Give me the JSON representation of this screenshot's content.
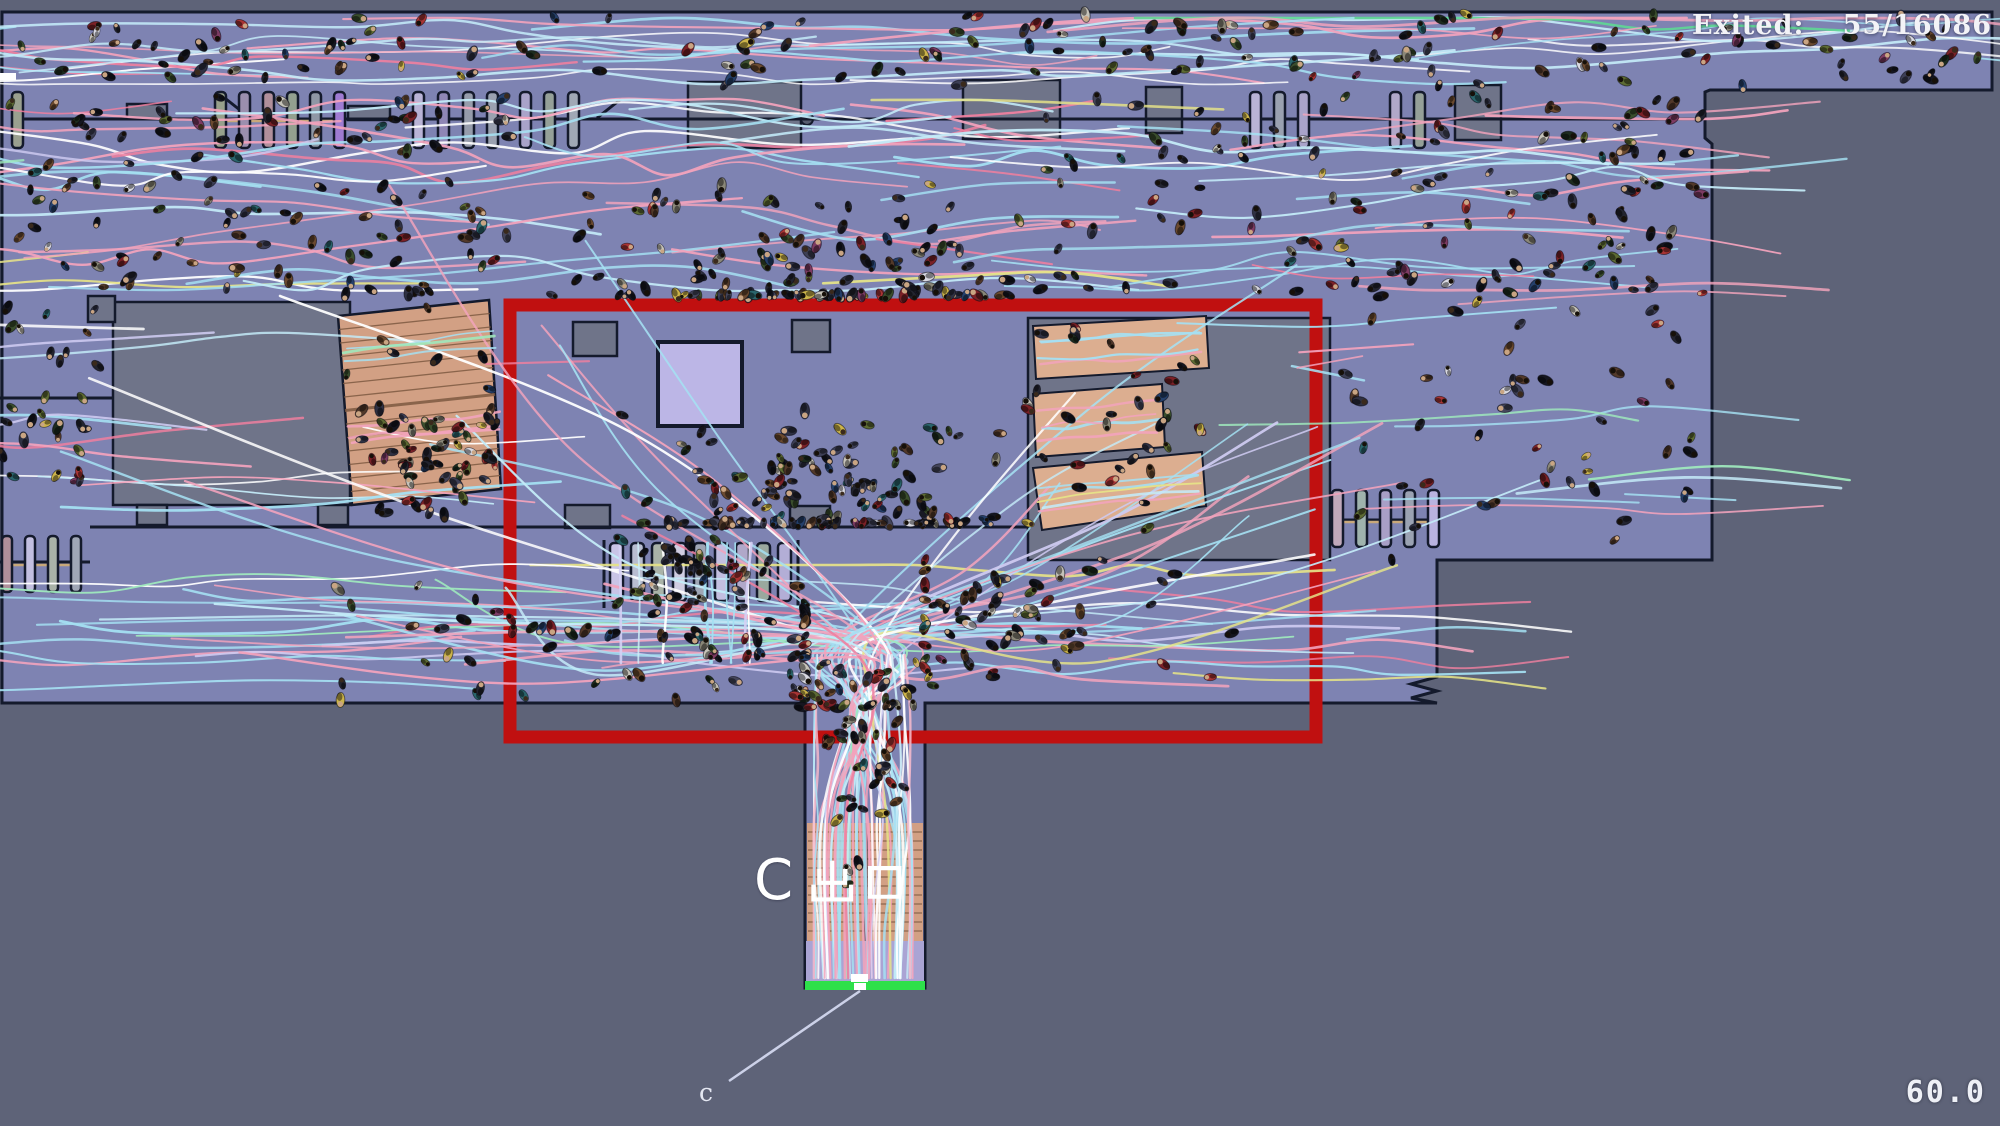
{
  "hud": {
    "exited_label": "Exited:",
    "exited_value": "55/16086",
    "timer": "60.0"
  },
  "labels": {
    "exit_sign": "C 出口",
    "exit_letter": "C",
    "leader": "c"
  },
  "colors": {
    "outside": "#5e6378",
    "floor": "#7e83b2",
    "block": "#6f7489",
    "wall": "#141a2c",
    "stair_tan": "#d2a084",
    "stair_step": "#7e5a42",
    "ramp_tan": "#dcae90",
    "lavender_block": "#bcb6e6",
    "corridor_lavender": "#aaa4d4",
    "exit_green": "#2ee04a",
    "highlight_red": "#c01010",
    "leader_line": "#ccd1e8",
    "accent_tan": "#c8a87a",
    "white": "#ffffff"
  },
  "scene": {
    "width": 2000,
    "height": 1126,
    "seed": 11,
    "floor_points": [
      [
        8,
        12
      ],
      [
        1992,
        12
      ],
      [
        1992,
        90
      ],
      [
        1710,
        90
      ],
      [
        1705,
        92
      ],
      [
        1705,
        138
      ],
      [
        1712,
        144
      ],
      [
        1712,
        560
      ],
      [
        1437,
        560
      ],
      [
        1437,
        677
      ],
      [
        1411,
        684
      ],
      [
        1437,
        691
      ],
      [
        1411,
        698
      ],
      [
        1437,
        703
      ],
      [
        925,
        703
      ],
      [
        925,
        988
      ],
      [
        805,
        988
      ],
      [
        805,
        703
      ],
      [
        2,
        703
      ],
      [
        2,
        12
      ]
    ],
    "walls": [
      [
        12,
        119,
        1698,
        119
      ],
      [
        250,
        118,
        226,
        99
      ],
      [
        597,
        118,
        621,
        99
      ],
      [
        0,
        398,
        113,
        398
      ],
      [
        90,
        527,
        1028,
        527
      ],
      [
        0,
        562,
        90,
        562
      ],
      [
        1330,
        520,
        1437,
        520
      ],
      [
        604,
        540,
        604,
        608
      ],
      [
        798,
        540,
        798,
        608
      ]
    ],
    "accents": [
      [
        215,
        121,
        345,
        121
      ],
      [
        10,
        565,
        72,
        565
      ],
      [
        1333,
        522,
        1434,
        522
      ]
    ],
    "blocks": [
      [
        113,
        302,
        237,
        203
      ],
      [
        88,
        296,
        27,
        26
      ],
      [
        137,
        505,
        30,
        20
      ],
      [
        318,
        505,
        30,
        20
      ],
      [
        573,
        322,
        44,
        34
      ],
      [
        792,
        320,
        38,
        32
      ],
      [
        565,
        505,
        45,
        23
      ],
      [
        790,
        506,
        40,
        21
      ],
      [
        1028,
        318,
        302,
        242
      ],
      [
        127,
        104,
        40,
        15
      ],
      [
        348,
        106,
        42,
        14
      ],
      [
        688,
        82,
        113,
        66
      ],
      [
        963,
        80,
        97,
        59
      ],
      [
        1146,
        87,
        36,
        46
      ],
      [
        1455,
        85,
        46,
        55
      ]
    ],
    "kiosk_circle": [
      807,
      119,
      6
    ],
    "white_tick": [
      0,
      73,
      16,
      7
    ],
    "left_stair": {
      "quad": [
        [
          338,
          316
        ],
        [
          489,
          300
        ],
        [
          501,
          489
        ],
        [
          352,
          505
        ]
      ],
      "steps": 14
    },
    "ramps": [
      {
        "quad": [
          [
            1033,
            326
          ],
          [
            1206,
            316
          ],
          [
            1209,
            368
          ],
          [
            1036,
            379
          ]
        ]
      },
      {
        "quad": [
          [
            1033,
            394
          ],
          [
            1162,
            384
          ],
          [
            1165,
            447
          ],
          [
            1036,
            457
          ]
        ]
      },
      {
        "quad": [
          [
            1033,
            468
          ],
          [
            1202,
            452
          ],
          [
            1206,
            506
          ],
          [
            1042,
            530
          ]
        ]
      }
    ],
    "corridor": {
      "stair_left": [
        807,
        823,
        57,
        118
      ],
      "stair_right": [
        866,
        823,
        57,
        118
      ],
      "divider": [
        866,
        823,
        866,
        941
      ],
      "steps_y": [
        832,
        932,
        9
      ],
      "lavender": [
        806,
        941,
        118,
        41
      ],
      "green": [
        805,
        981,
        120,
        9
      ],
      "ticks": [
        [
          851,
          974,
          17,
          8
        ],
        [
          854,
          983,
          12,
          7
        ]
      ]
    },
    "gate_rows": [
      {
        "y": 92,
        "h": 56,
        "w": 11,
        "bars": [
          [
            12,
            "#9aa08f"
          ],
          [
            215,
            "#97a08b"
          ],
          [
            239,
            "#9b8fae"
          ],
          [
            263,
            "#b08f9b"
          ],
          [
            287,
            "#93a08f"
          ],
          [
            310,
            "#8f97a5"
          ],
          [
            334,
            "#9f7bd2"
          ],
          [
            413,
            "#b9b3d6"
          ],
          [
            438,
            "#8f86b5"
          ],
          [
            463,
            "#969cab"
          ],
          [
            487,
            "#9aa1b0"
          ],
          [
            520,
            "#a9a3c9"
          ],
          [
            544,
            "#95a098"
          ],
          [
            568,
            "#a0a8b5"
          ],
          [
            1250,
            "#b9b3d6"
          ],
          [
            1274,
            "#9aa1b0"
          ],
          [
            1298,
            "#a9a3c9"
          ],
          [
            1390,
            "#b0a8c9"
          ],
          [
            1414,
            "#95a098"
          ]
        ]
      },
      {
        "y": 543,
        "h": 58,
        "w": 13,
        "bars": [
          [
            610,
            "#c9c4e6"
          ],
          [
            631,
            "#b8bdd0"
          ],
          [
            652,
            "#aab3a8"
          ],
          [
            673,
            "#d0cde2"
          ],
          [
            694,
            "#9fa6b5"
          ],
          [
            715,
            "#c3bfe0"
          ],
          [
            736,
            "#b0a8c9"
          ],
          [
            757,
            "#9aa89e"
          ],
          [
            778,
            "#b3aed6"
          ]
        ]
      },
      {
        "y": 536,
        "h": 56,
        "w": 10,
        "bars": [
          [
            2,
            "#b08f9b"
          ],
          [
            25,
            "#c3bfe0"
          ],
          [
            48,
            "#aab3a8"
          ],
          [
            71,
            "#9fa6b5"
          ]
        ]
      },
      {
        "y": 490,
        "h": 57,
        "w": 11,
        "bars": [
          [
            1332,
            "#c0a9bb"
          ],
          [
            1356,
            "#9fb3ad"
          ],
          [
            1380,
            "#a89fc6"
          ],
          [
            1404,
            "#9aa2b2"
          ],
          [
            1428,
            "#b9b3e0"
          ]
        ]
      }
    ],
    "red_box": [
      510,
      305,
      806,
      432
    ],
    "red_box_stroke": 13,
    "leader_line": [
      860,
      991,
      729,
      1081
    ],
    "trail_palette": [
      [
        "#a5e0f2",
        30
      ],
      [
        "#c4ebf8",
        12
      ],
      [
        "#f2a3bc",
        22
      ],
      [
        "#ee7f9f",
        7
      ],
      [
        "#ffffff",
        12
      ],
      [
        "#cecaf0",
        7
      ],
      [
        "#9fe9bd",
        5
      ],
      [
        "#5fd794",
        2
      ],
      [
        "#e6e388",
        3
      ]
    ],
    "trail_palette_light": [
      [
        "#ffffff",
        35
      ],
      [
        "#cfeef8",
        25
      ],
      [
        "#a5e0f2",
        20
      ],
      [
        "#d4d0f4",
        12
      ],
      [
        "#f4b9cb",
        8
      ]
    ],
    "trail_groups": [
      {
        "type": "h",
        "region": [
          10,
          18,
          1975,
          66
        ],
        "count": 30,
        "amp": 28,
        "len": [
          500,
          1500
        ]
      },
      {
        "type": "h",
        "region": [
          5,
          100,
          1000,
          190
        ],
        "count": 38,
        "amp": 44,
        "len": [
          380,
          1050
        ]
      },
      {
        "type": "h",
        "region": [
          1000,
          100,
          700,
          190
        ],
        "count": 24,
        "amp": 38,
        "len": [
          320,
          850
        ]
      },
      {
        "type": "h",
        "region": [
          1340,
          115,
          355,
          420
        ],
        "count": 15,
        "amp": 30,
        "len": [
          220,
          480
        ]
      },
      {
        "type": "h",
        "region": [
          5,
          565,
          1420,
          125
        ],
        "count": 26,
        "amp": 30,
        "len": [
          380,
          1150
        ]
      },
      {
        "type": "h",
        "region": [
          5,
          315,
          495,
          195
        ],
        "count": 13,
        "amp": 34,
        "len": [
          240,
          600
        ]
      },
      {
        "type": "funnel",
        "sources": [
          [
            5,
            110,
            620,
            420
          ],
          [
            950,
            110,
            680,
            380
          ],
          [
            1230,
            420,
            200,
            230
          ],
          [
            30,
            565,
            580,
            120
          ]
        ],
        "target": [
          863,
          700
        ],
        "count": 46
      },
      {
        "type": "v",
        "region": [
          814,
          655,
          96,
          323
        ],
        "count": 12,
        "palette": "light"
      },
      {
        "type": "v",
        "region": [
          612,
          543,
          180,
          120
        ],
        "count": 9,
        "palette": "light"
      },
      {
        "type": "along",
        "line": [
          1040,
          350,
          1200,
          340
        ],
        "count": 4,
        "spread": 16
      },
      {
        "type": "along",
        "line": [
          1040,
          424,
          1158,
          414
        ],
        "count": 4,
        "spread": 17
      },
      {
        "type": "along",
        "line": [
          1040,
          497,
          1198,
          480
        ],
        "count": 5,
        "spread": 17
      },
      {
        "type": "along",
        "line": [
          345,
          352,
          494,
          338
        ],
        "count": 3,
        "spread": 11
      },
      {
        "type": "along",
        "line": [
          349,
          432,
          499,
          418
        ],
        "count": 3,
        "spread": 11
      }
    ],
    "agent_palette": [
      [
        "#15161f",
        16
      ],
      [
        "#23242f",
        10
      ],
      [
        "#2f3143",
        8
      ],
      [
        "#3d3f55",
        6
      ],
      [
        "#52392a",
        6
      ],
      [
        "#6b4a2f",
        5
      ],
      [
        "#7b2127",
        6
      ],
      [
        "#a83434",
        3
      ],
      [
        "#3a4e2d",
        6
      ],
      [
        "#5d6b33",
        4
      ],
      [
        "#25406b",
        4
      ],
      [
        "#8a8778",
        4
      ],
      [
        "#c6c3b9",
        3
      ],
      [
        "#ccb44a",
        3
      ],
      [
        "#2a656c",
        3
      ],
      [
        "#7d3b63",
        2
      ],
      [
        "#d9d9e2",
        2
      ],
      [
        "#44455a",
        4
      ],
      [
        "#1d2b1e",
        4
      ]
    ],
    "head_palette": [
      [
        "#161009",
        55
      ],
      [
        "#c9a583",
        30
      ],
      [
        "#3a2a1c",
        15
      ]
    ],
    "clusters": [
      {
        "rect": [
          10,
          14,
          1975,
          72
        ],
        "count": 150
      },
      {
        "rect": [
          5,
          95,
          505,
          200
        ],
        "count": 115
      },
      {
        "rect": [
          510,
          95,
          520,
          200
        ],
        "count": 130,
        "focus": [
          790,
          280
        ],
        "k": 0.45
      },
      {
        "rect": [
          1030,
          95,
          675,
          200
        ],
        "count": 105
      },
      {
        "rect": [
          0,
          305,
          113,
          200
        ],
        "count": 30
      },
      {
        "rect": [
          350,
          380,
          165,
          140
        ],
        "count": 45,
        "focus": [
          430,
          470
        ],
        "k": 0.5
      },
      {
        "rect": [
          340,
          305,
          160,
          200
        ],
        "count": 18
      },
      {
        "rect": [
          512,
          307,
          516,
          216
        ],
        "count": 150,
        "focus": [
          820,
          500
        ],
        "k": 0.5
      },
      {
        "rect": [
          1033,
          322,
          180,
          210
        ],
        "count": 30
      },
      {
        "rect": [
          1335,
          230,
          100,
          330
        ],
        "count": 18
      },
      {
        "rect": [
          1440,
          95,
          265,
          455
        ],
        "count": 65
      },
      {
        "rect": [
          5,
          560,
          800,
          140
        ],
        "count": 85,
        "focus": [
          690,
          645
        ],
        "k": 0.4
      },
      {
        "rect": [
          925,
          560,
          510,
          140
        ],
        "count": 65,
        "focus": [
          1010,
          620
        ],
        "k": 0.5
      },
      {
        "rect": [
          600,
          527,
          205,
          85
        ],
        "count": 35,
        "focus": [
          700,
          570
        ],
        "k": 0.5
      },
      {
        "rect": [
          807,
          705,
          116,
          275
        ],
        "count": 40,
        "focus": [
          865,
          765
        ],
        "k": 0.5
      },
      {
        "rect": [
          775,
          635,
          165,
          72
        ],
        "count": 30,
        "focus": [
          860,
          685
        ],
        "k": 0.5
      }
    ]
  }
}
